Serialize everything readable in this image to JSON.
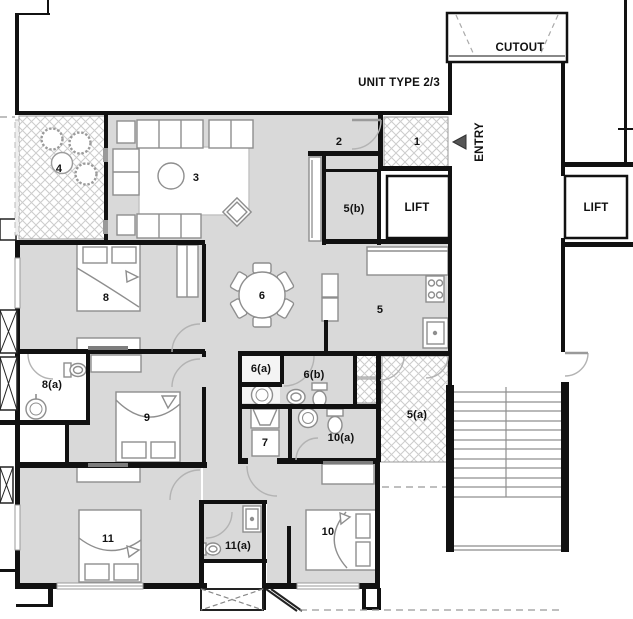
{
  "title": "UNIT TYPE 2/3",
  "labels": {
    "unit_type": "UNIT TYPE  2/3",
    "cutout": "CUTOUT",
    "entry": "ENTRY",
    "lift": "LIFT",
    "r1": "1",
    "r2": "2",
    "r3": "3",
    "r4": "4",
    "r5": "5",
    "r5a": "5(a)",
    "r5b": "5(b)",
    "r6": "6",
    "r6a": "6(a)",
    "r6b": "6(b)",
    "r7": "7",
    "r8": "8",
    "r8a": "8(a)",
    "r9": "9",
    "r10": "10",
    "r10a": "10(a)",
    "r11": "11",
    "r11a": "11(a)"
  },
  "colors": {
    "floor": "#d9d9d9",
    "wall": "#111111",
    "furniture_stroke": "#8e8e8e",
    "hatch_line": "#cccccc",
    "door_arc": "#b3b3b3"
  }
}
